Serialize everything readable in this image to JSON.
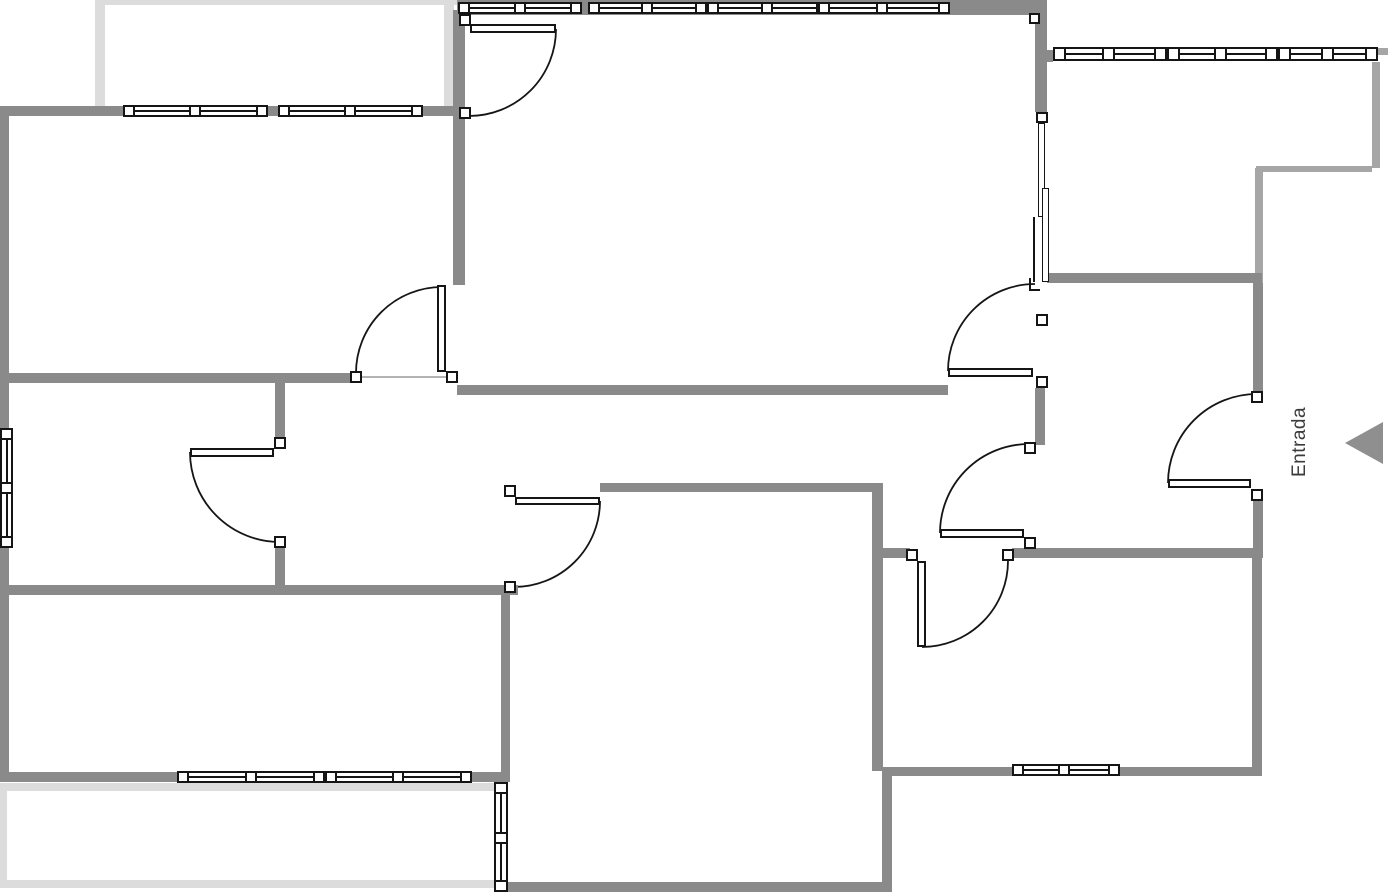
{
  "app": {
    "title": "Floor plan"
  },
  "entrance": {
    "label": "Entrada"
  },
  "colors": {
    "wall": "#8a8a8a",
    "wall_light": "#a6a6a6",
    "terrace": "#dcdcdc",
    "line": "#151515",
    "text": "#3b3b3b",
    "arrow": "#8f8f8f",
    "background": "#ffffff"
  },
  "canvas": {
    "width": 1395,
    "height": 892
  },
  "plan": {
    "walls": [
      [
        0,
        106,
        458,
        10
      ],
      [
        457,
        0,
        580,
        15
      ],
      [
        0,
        373,
        356,
        10
      ],
      [
        457,
        385,
        491,
        10
      ],
      [
        600,
        483,
        282,
        9
      ],
      [
        0,
        585,
        518,
        10
      ],
      [
        0,
        772,
        510,
        10
      ],
      [
        508,
        882,
        374,
        10
      ],
      [
        883,
        767,
        373,
        9
      ],
      [
        872,
        548,
        38,
        10
      ],
      [
        1012,
        548,
        244,
        10
      ],
      [
        1047,
        273,
        215,
        10
      ],
      [
        1045,
        50,
        8,
        12
      ],
      [
        0,
        106,
        9,
        322
      ],
      [
        0,
        548,
        9,
        224
      ],
      [
        453,
        10,
        12,
        275
      ],
      [
        275,
        373,
        10,
        65
      ],
      [
        275,
        548,
        10,
        37
      ],
      [
        501,
        592,
        9,
        185
      ],
      [
        872,
        483,
        11,
        288
      ],
      [
        882,
        767,
        10,
        125
      ],
      [
        1035,
        0,
        12,
        112
      ],
      [
        1035,
        388,
        10,
        57
      ],
      [
        1253,
        283,
        10,
        109
      ],
      [
        1253,
        500,
        10,
        58
      ],
      [
        1252,
        558,
        10,
        218
      ]
    ],
    "light_walls": [
      [
        1372,
        62,
        8,
        106
      ],
      [
        1256,
        166,
        116,
        6
      ],
      [
        1255,
        168,
        8,
        115
      ],
      [
        1378,
        48,
        10,
        7
      ]
    ],
    "terrace_edges": [
      [
        95,
        0,
        10,
        106
      ],
      [
        95,
        0,
        363,
        5
      ],
      [
        444,
        0,
        10,
        106
      ],
      [
        0,
        783,
        507,
        8
      ],
      [
        0,
        783,
        7,
        105
      ],
      [
        0,
        880,
        507,
        8
      ]
    ],
    "windows": [
      {
        "id": "window-topleft-1",
        "orient": "h",
        "frame": [
          123,
          105,
          145,
          12
        ],
        "posts": [
          [
            123,
            105,
            12,
            12
          ],
          [
            189,
            105,
            12,
            12
          ],
          [
            256,
            105,
            12,
            12
          ]
        ]
      },
      {
        "id": "window-topleft-2",
        "orient": "h",
        "frame": [
          278,
          105,
          145,
          12
        ],
        "posts": [
          [
            278,
            105,
            12,
            12
          ],
          [
            344,
            105,
            12,
            12
          ],
          [
            411,
            105,
            12,
            12
          ]
        ]
      },
      {
        "id": "window-top-1",
        "orient": "h",
        "frame": [
          458,
          2,
          124,
          12
        ],
        "posts": [
          [
            458,
            2,
            12,
            12
          ],
          [
            514,
            2,
            12,
            12
          ],
          [
            570,
            2,
            12,
            12
          ]
        ]
      },
      {
        "id": "window-top-2",
        "orient": "h",
        "frame": [
          588,
          2,
          119,
          12
        ],
        "posts": [
          [
            588,
            2,
            12,
            12
          ],
          [
            641,
            2,
            12,
            12
          ],
          [
            695,
            2,
            12,
            12
          ]
        ]
      },
      {
        "id": "window-top-3",
        "orient": "h",
        "frame": [
          707,
          2,
          121,
          12
        ],
        "posts": [
          [
            707,
            2,
            12,
            12
          ],
          [
            761,
            2,
            12,
            12
          ],
          [
            816,
            2,
            12,
            12
          ]
        ]
      },
      {
        "id": "window-top-4",
        "orient": "h",
        "frame": [
          818,
          2,
          132,
          12
        ],
        "posts": [
          [
            818,
            2,
            12,
            12
          ],
          [
            876,
            2,
            12,
            12
          ],
          [
            938,
            2,
            12,
            12
          ]
        ]
      },
      {
        "id": "window-topright-1",
        "orient": "h",
        "frame": [
          1053,
          47,
          114,
          14
        ],
        "posts": [
          [
            1053,
            47,
            13,
            14
          ],
          [
            1102,
            47,
            13,
            14
          ],
          [
            1154,
            47,
            13,
            14
          ]
        ]
      },
      {
        "id": "window-topright-2",
        "orient": "h",
        "frame": [
          1167,
          47,
          111,
          14
        ],
        "posts": [
          [
            1167,
            47,
            13,
            14
          ],
          [
            1214,
            47,
            13,
            14
          ],
          [
            1265,
            47,
            13,
            14
          ]
        ]
      },
      {
        "id": "window-topright-3",
        "orient": "h",
        "frame": [
          1278,
          47,
          100,
          14
        ],
        "posts": [
          [
            1278,
            47,
            13,
            14
          ],
          [
            1321,
            47,
            13,
            14
          ],
          [
            1365,
            47,
            13,
            14
          ]
        ]
      },
      {
        "id": "window-bottomleft-1",
        "orient": "h",
        "frame": [
          177,
          771,
          148,
          12
        ],
        "posts": [
          [
            177,
            771,
            12,
            12
          ],
          [
            245,
            771,
            12,
            12
          ],
          [
            313,
            771,
            12,
            12
          ]
        ]
      },
      {
        "id": "window-bottomleft-2",
        "orient": "h",
        "frame": [
          325,
          771,
          147,
          12
        ],
        "posts": [
          [
            325,
            771,
            12,
            12
          ],
          [
            392,
            771,
            12,
            12
          ],
          [
            460,
            771,
            12,
            12
          ]
        ]
      },
      {
        "id": "window-bottomright",
        "orient": "h",
        "frame": [
          1012,
          764,
          108,
          12
        ],
        "posts": [
          [
            1012,
            764,
            12,
            12
          ],
          [
            1058,
            764,
            12,
            12
          ],
          [
            1108,
            764,
            12,
            12
          ]
        ]
      },
      {
        "id": "window-left-wall",
        "orient": "v",
        "frame": [
          0,
          428,
          13,
          120
        ],
        "posts": [
          [
            0,
            428,
            13,
            12
          ],
          [
            0,
            482,
            13,
            12
          ],
          [
            0,
            536,
            13,
            12
          ]
        ]
      },
      {
        "id": "window-center-left",
        "orient": "v",
        "frame": [
          494,
          782,
          14,
          110
        ],
        "posts": [
          [
            494,
            782,
            14,
            12
          ],
          [
            494,
            832,
            14,
            12
          ],
          [
            494,
            880,
            14,
            12
          ]
        ]
      }
    ],
    "sliding_window": {
      "id": "sliding-window-right-wall",
      "post": [
        1036,
        112,
        12,
        11
      ],
      "corner_post": [
        1029,
        13,
        11,
        11
      ],
      "panels": [
        [
          1038,
          123,
          7,
          94
        ],
        [
          1042,
          188,
          7,
          94
        ]
      ],
      "rail": [
        1033,
        217,
        2,
        65
      ],
      "bracket": [
        [
          1029,
          278,
          2,
          13
        ],
        [
          1029,
          289,
          11,
          2
        ]
      ]
    },
    "doors": [
      {
        "id": "door-hall-topleft",
        "posts": [
          [
            350,
            371,
            12,
            12
          ],
          [
            446,
            371,
            12,
            12
          ]
        ],
        "leaf": [
          437,
          285,
          9,
          87
        ],
        "arc": "M 442 287 A 86 86 0 0 0 356 373"
      },
      {
        "id": "door-livingroom-top",
        "posts": [
          [
            459,
            14,
            12,
            12
          ],
          [
            459,
            107,
            12,
            12
          ]
        ],
        "leaf": [
          470,
          24,
          86,
          9
        ],
        "arc": "M 556 29 A 87 87 0 0 1 469 116"
      },
      {
        "id": "door-midleft-room",
        "posts": [
          [
            274,
            437,
            12,
            12
          ],
          [
            274,
            536,
            12,
            12
          ]
        ],
        "leaf": [
          190,
          448,
          84,
          9
        ],
        "arc": "M 190 452 A 90 90 0 0 0 280 542"
      },
      {
        "id": "door-bottomcenter-room",
        "posts": [
          [
            504,
            485,
            12,
            12
          ],
          [
            504,
            581,
            12,
            12
          ]
        ],
        "leaf": [
          515,
          497,
          85,
          8
        ],
        "arc": "M 600 501 A 86 86 0 0 1 514 587"
      },
      {
        "id": "door-livingroom-bottom",
        "posts": [
          [
            1036,
            314,
            12,
            12
          ],
          [
            1036,
            376,
            12,
            12
          ]
        ],
        "leaf": [
          948,
          368,
          85,
          9
        ],
        "arc": "M 948 371 A 87 87 0 0 1 1035 284"
      },
      {
        "id": "door-hall-entrance",
        "posts": [
          [
            1024,
            442,
            12,
            12
          ],
          [
            1024,
            537,
            12,
            12
          ]
        ],
        "leaf": [
          940,
          529,
          84,
          9
        ],
        "arc": "M 940 533 A 89 89 0 0 1 1029 444"
      },
      {
        "id": "door-bottomright-room",
        "posts": [
          [
            906,
            549,
            12,
            12
          ],
          [
            1002,
            549,
            12,
            12
          ]
        ],
        "leaf": [
          917,
          561,
          9,
          86
        ],
        "arc": "M 922 647 A 86 86 0 0 0 1008 561"
      },
      {
        "id": "door-entrada",
        "posts": [
          [
            1251,
            391,
            12,
            12
          ],
          [
            1251,
            489,
            12,
            12
          ]
        ],
        "leaf": [
          1168,
          479,
          83,
          9
        ],
        "arc": "M 1168 483 A 89 89 0 0 1 1257 394"
      }
    ],
    "threshold": [
      362,
      377,
      446,
      377
    ]
  }
}
